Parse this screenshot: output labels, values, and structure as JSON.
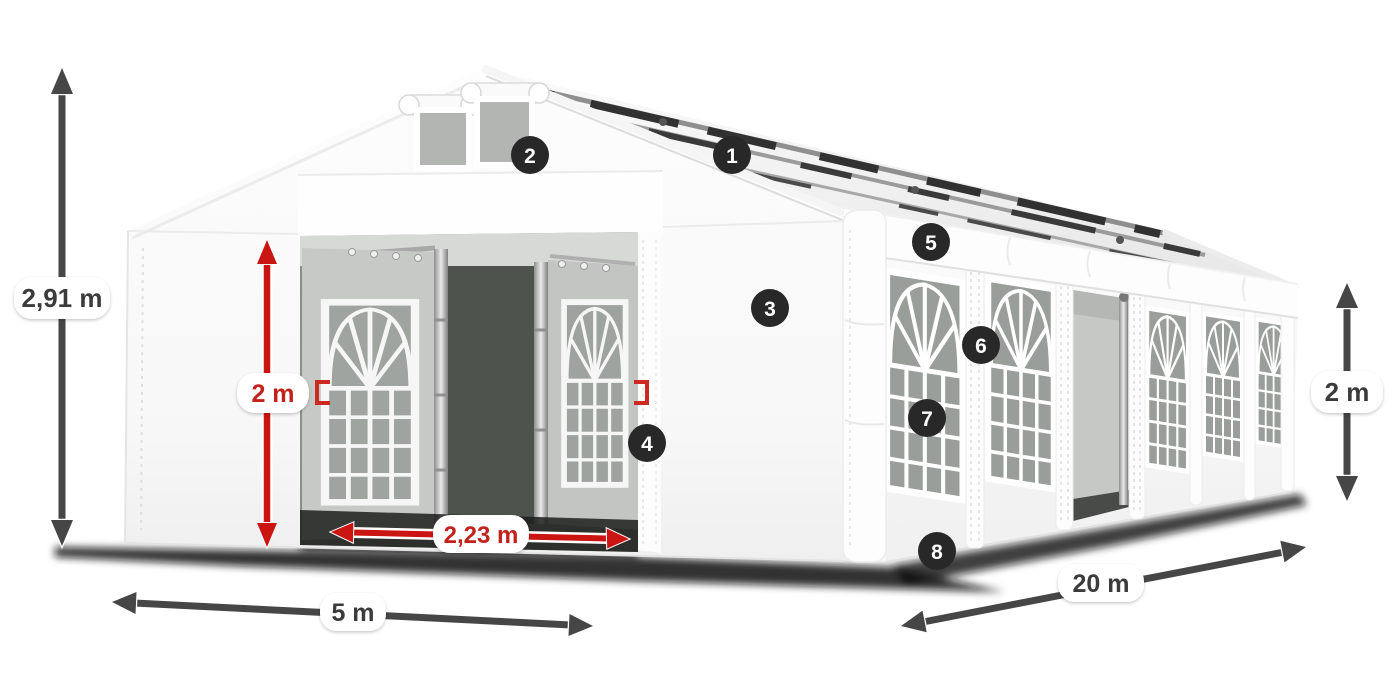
{
  "image": {
    "width": 1400,
    "height": 700,
    "background": "#ffffff",
    "description": "White PVC marquee party tent 5 x 20 m, front entrance open, with numbered feature callouts and dimension arrows"
  },
  "dimensions": [
    {
      "id": "total-height",
      "label": "2,91 m",
      "style": "dark"
    },
    {
      "id": "entrance-height",
      "label": "2 m",
      "style": "red"
    },
    {
      "id": "entrance-width",
      "label": "2,23 m",
      "style": "red"
    },
    {
      "id": "span-width",
      "label": "5 m",
      "style": "dark"
    },
    {
      "id": "length",
      "label": "20 m",
      "style": "dark"
    },
    {
      "id": "side-height",
      "label": "2 m",
      "style": "dark"
    }
  ],
  "callouts": [
    {
      "number": "1"
    },
    {
      "number": "2"
    },
    {
      "number": "3"
    },
    {
      "number": "4"
    },
    {
      "number": "5"
    },
    {
      "number": "6"
    },
    {
      "number": "7"
    },
    {
      "number": "8"
    }
  ],
  "colors": {
    "red_arrow": "#cb1512",
    "red_text": "#c3231d",
    "dark_arrow": "#464646",
    "dark_text": "#3a3a3a",
    "badge_bg": "#282828",
    "badge_text": "#ffffff",
    "pill_bg": "#ffffff"
  }
}
